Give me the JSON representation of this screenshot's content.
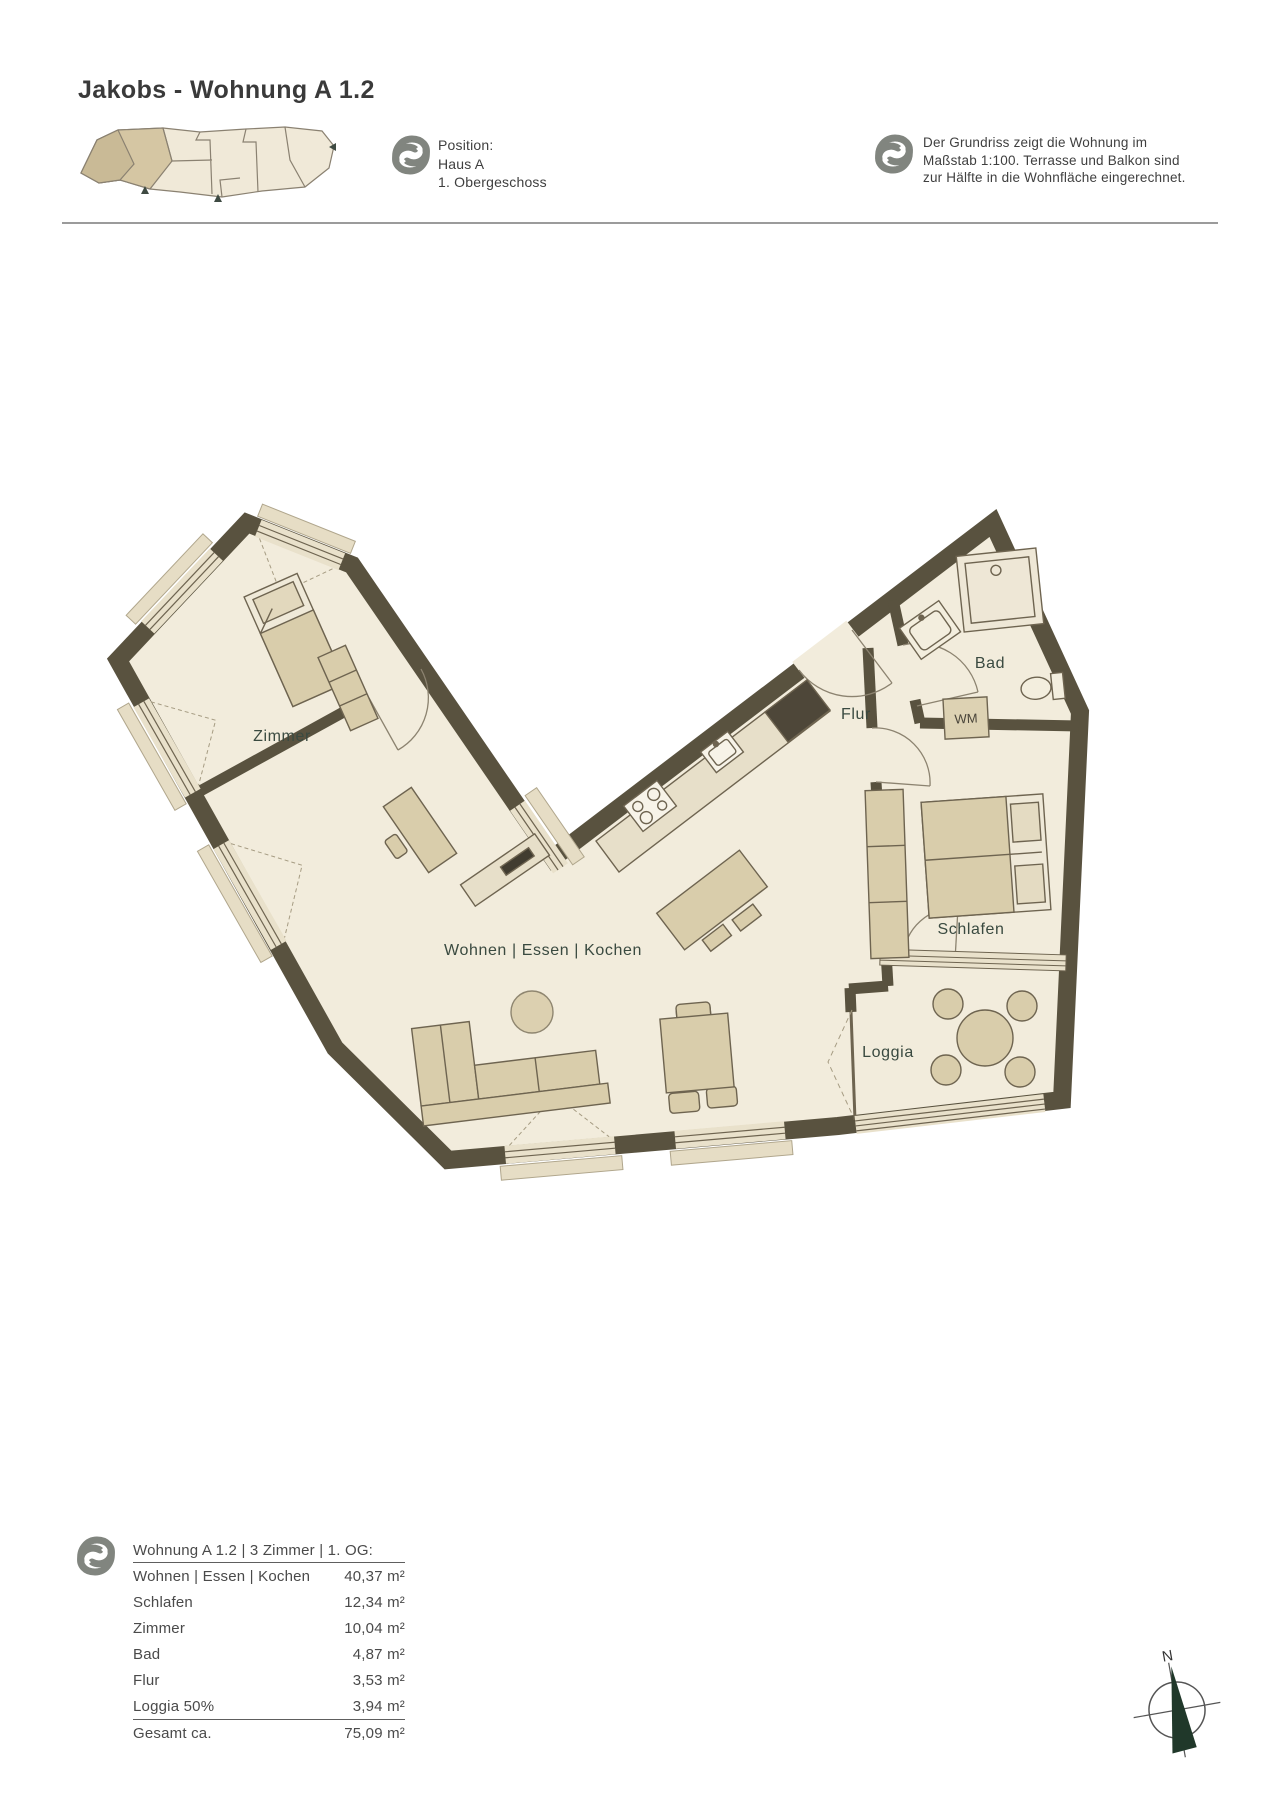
{
  "page": {
    "title": "Jakobs - Wohnung A 1.2"
  },
  "header": {
    "position": {
      "heading": "Position:",
      "line1": "Haus A",
      "line2": "1. Obergeschoss"
    },
    "note": {
      "line1": "Der Grundriss zeigt die Wohnung im",
      "line2": "Maßstab 1:100. Terrasse und Balkon sind",
      "line3": "zur Hälfte in die Wohnfläche eingerechnet."
    }
  },
  "plan": {
    "rooms": {
      "zimmer": "Zimmer",
      "wohnen": "Wohnen | Essen | Kochen",
      "flur": "Flur",
      "bad": "Bad",
      "wm": "WM",
      "schlafen": "Schlafen",
      "loggia": "Loggia"
    }
  },
  "area_table": {
    "header": "Wohnung A 1.2 | 3 Zimmer | 1. OG:",
    "rows": [
      {
        "label": "Wohnen | Essen | Kochen",
        "value": "40,37 m²"
      },
      {
        "label": "Schlafen",
        "value": "12,34 m²"
      },
      {
        "label": "Zimmer",
        "value": "10,04 m²"
      },
      {
        "label": "Bad",
        "value": "4,87 m²"
      },
      {
        "label": "Flur",
        "value": "3,53 m²"
      },
      {
        "label": "Loggia 50%",
        "value": "3,94 m²"
      }
    ],
    "total": {
      "label": "Gesamt ca.",
      "value": "75,09 m²"
    }
  },
  "compass": {
    "north_label": "N"
  },
  "colors": {
    "wall": "#59523f",
    "floor": "#f2ecdc",
    "furniture": "#d9cdab",
    "window_band": "#e9e1cb",
    "label_green": "#3a4a40",
    "compass_green": "#20382a",
    "logo_gray": "#81857f",
    "site_highlight": "#d5c6a3"
  }
}
